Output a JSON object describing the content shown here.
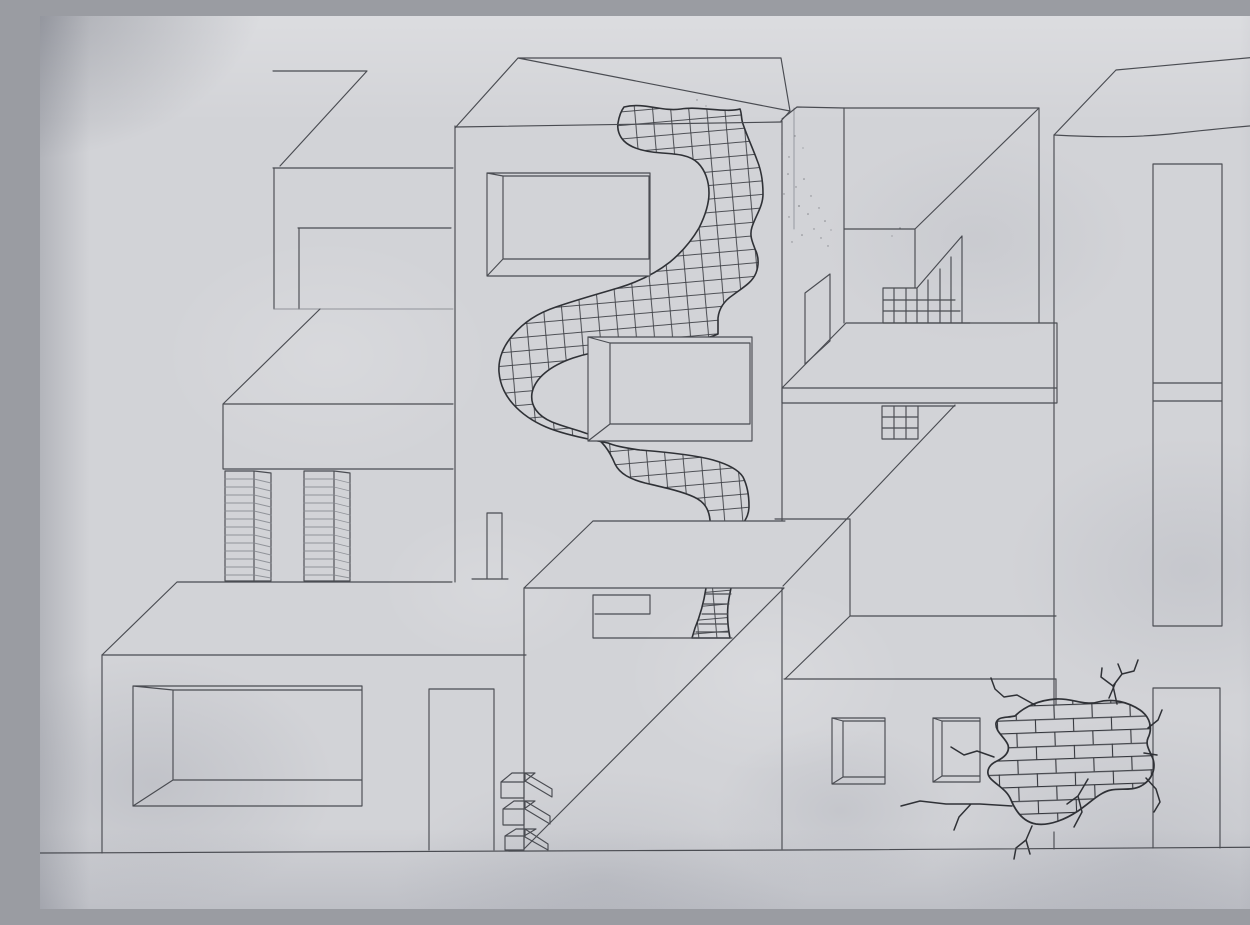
{
  "scene": {
    "type": "photograph of a hand-drawn pencil sketch on lightly crumpled paper",
    "subject": "Abstract modernist buildings in axonometric perspective: left flat-roof block over a slab with two hatched columns, a large lower-left building with a recessed opening and a doorway, a tall central tower with two deep-set windows and a winding grid-tiled path flowing down its face, a right courtyard with balcony slab, open door panel and stepped railing grid, a low wall with two small perspective windows, a cracked hole exposing brickwork, and a tall right building with an elongated window and a doorway, all standing on a single ground line",
    "medium": "graphite pencil with darker pen accents on the tiled path, bricks and cracks",
    "paper": "light gray, creased and crumpled, darker vignette in the top-left corner"
  },
  "colors": {
    "paper": "#d2d3d7",
    "paper_shade": "#c6c8cd",
    "paper_dark": "#b4b6bd",
    "pencil": "#4a4c52",
    "pencil_dark": "#2f3136",
    "pencil_faint": "#85878e"
  },
  "elements": {
    "left_building": "flat-roofed block, top-left",
    "left_slab": "horizontal slab with two hatched columns beneath",
    "bottom_left_building": "large block with recessed opening and doorway",
    "center_tower": "tall building with two recessed windows and winding tiled path",
    "tiled_path": "S-shaped band filled with cross-grid tiles, dark outline",
    "center_lower_box": "box with long diagonal, step ledge, ladder band and corner bricks",
    "right_courtyard": "balcony slab, open door panel, stepped railing grid, interior corner lines",
    "low_wall": "wall with two small perspective windows",
    "cracked_hole": "irregular hole with exposed brick courses and radiating cracks",
    "right_building": "tall building with elongated window and doorway",
    "ground": "single ground line across the sheet"
  }
}
